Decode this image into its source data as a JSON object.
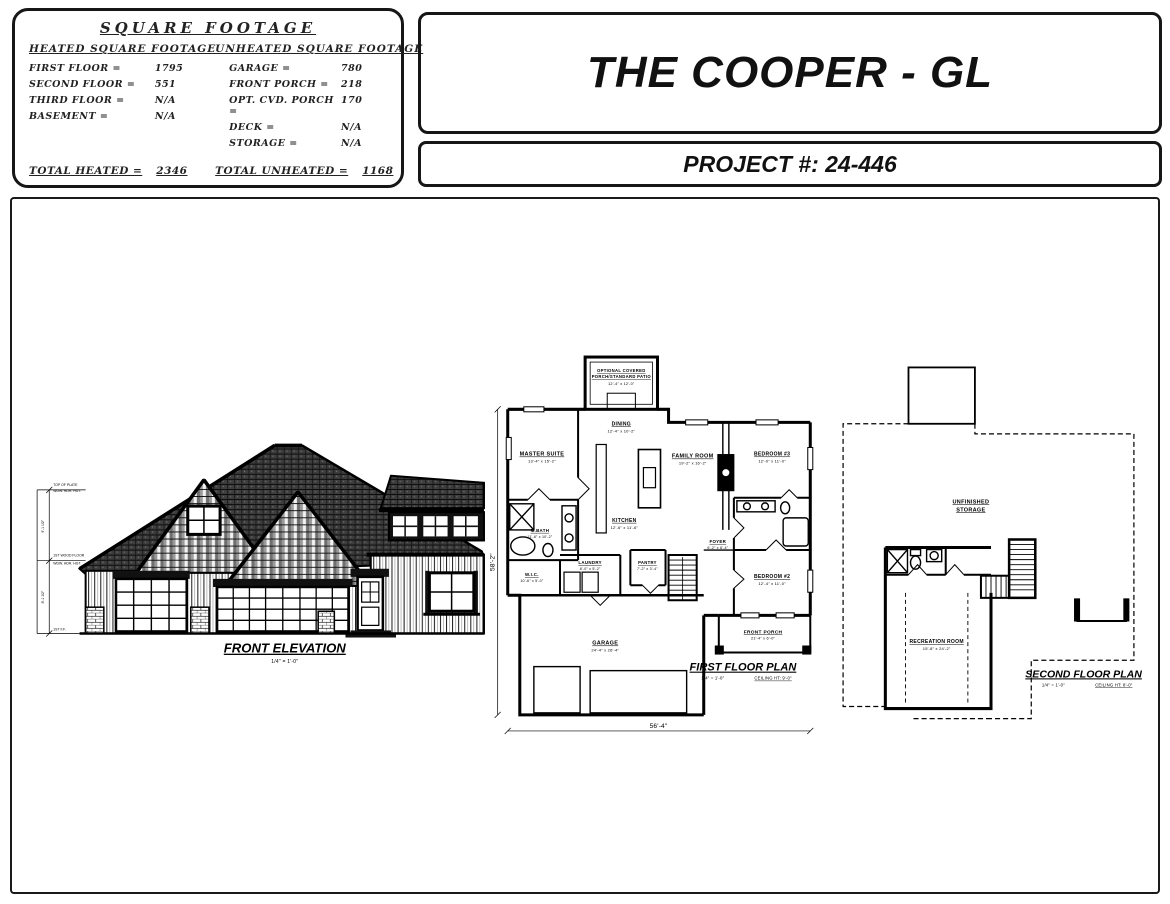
{
  "square_footage": {
    "title": "SQUARE FOOTAGE",
    "heated": {
      "title": "HEATED SQUARE FOOTAGE",
      "rows": [
        {
          "label": "FIRST FLOOR =",
          "value": "1795"
        },
        {
          "label": "SECOND FLOOR =",
          "value": "551"
        },
        {
          "label": "THIRD FLOOR =",
          "value": "N/A"
        },
        {
          "label": "BASEMENT =",
          "value": "N/A"
        }
      ],
      "total_label": "TOTAL HEATED =",
      "total_value": "2346"
    },
    "unheated": {
      "title": "UNHEATED SQUARE FOOTAGE",
      "rows": [
        {
          "label": "GARAGE =",
          "value": "780"
        },
        {
          "label": "FRONT PORCH =",
          "value": "218"
        },
        {
          "label": "OPT. CVD. PORCH =",
          "value": "170"
        },
        {
          "label": "DECK =",
          "value": "N/A"
        },
        {
          "label": "STORAGE =",
          "value": "N/A"
        }
      ],
      "total_label": "TOTAL UNHEATED =",
      "total_value": "1168"
    }
  },
  "title_block": {
    "plan_name": "THE COOPER - GL",
    "project_number": "PROJECT #: 24-446"
  },
  "elevation": {
    "label": "FRONT ELEVATION",
    "scale": "1/4\" = 1'-0\"",
    "annotations": {
      "top1": "TOP OF PLATE",
      "top2": "WDW. HDR. HGT.",
      "mid1": "1ST WOOD FLOOR",
      "mid2": "WDW. HDR. HGT.",
      "bottom": "1ST F.F.",
      "height_upper": "9'-1 1/2\"",
      "height_lower": "8'-1 1/2\""
    }
  },
  "first_floor": {
    "label": "FIRST FLOOR PLAN",
    "scale": "1/4\" = 1'-0\"",
    "ceiling": "CEILING HT: 9'-0\"",
    "width_dim": "56'-4\"",
    "height_dim": "58'-2\"",
    "rooms": [
      {
        "line1": "OPTIONAL COVERED",
        "line2": "PORCH/STANDARD PATIO",
        "dims": "12'-4\" x 12'-0\""
      },
      {
        "name": "DINING",
        "dims": "12'-4\" x 10'-2\""
      },
      {
        "name": "MASTER SUITE",
        "dims": "13'-4\" x 15'-2\""
      },
      {
        "name": "FAMILY ROOM",
        "dims": "19'-2\" x 16'-2\""
      },
      {
        "name": "BEDROOM #3",
        "dims": "12'-0\" x 11'-0\""
      },
      {
        "name": "KITCHEN",
        "dims": "12'-6\" x 11'-6\""
      },
      {
        "name": "M.BATH",
        "dims": "11'-6\" x 10'-2\""
      },
      {
        "name": "W.I.C.",
        "dims": "10'-6\" x 5'-0\""
      },
      {
        "name": "LAUNDRY",
        "dims": "8'-0\" x 5'-2\""
      },
      {
        "name": "PANTRY",
        "dims": "7'-2\" x 3'-4\""
      },
      {
        "name": "FOYER",
        "dims": "6'-2\" x 8'-4\""
      },
      {
        "name": "BEDROOM #2",
        "dims": "12'-4\" x 11'-0\""
      },
      {
        "name": "GARAGE",
        "dims": "24'-4\" x 26'-4\""
      },
      {
        "name": "FRONT PORCH",
        "dims": "21'-4\" x 6'-0\""
      }
    ]
  },
  "second_floor": {
    "label": "SECOND FLOOR PLAN",
    "scale": "1/4\" = 1'-0\"",
    "ceiling": "CEILING HT: 8'-0\"",
    "storage_line1": "UNFINISHED",
    "storage_line2": "STORAGE",
    "rec_room": {
      "name": "RECREATION ROOM",
      "dims": "15'-8\" x 24'-2\""
    }
  }
}
